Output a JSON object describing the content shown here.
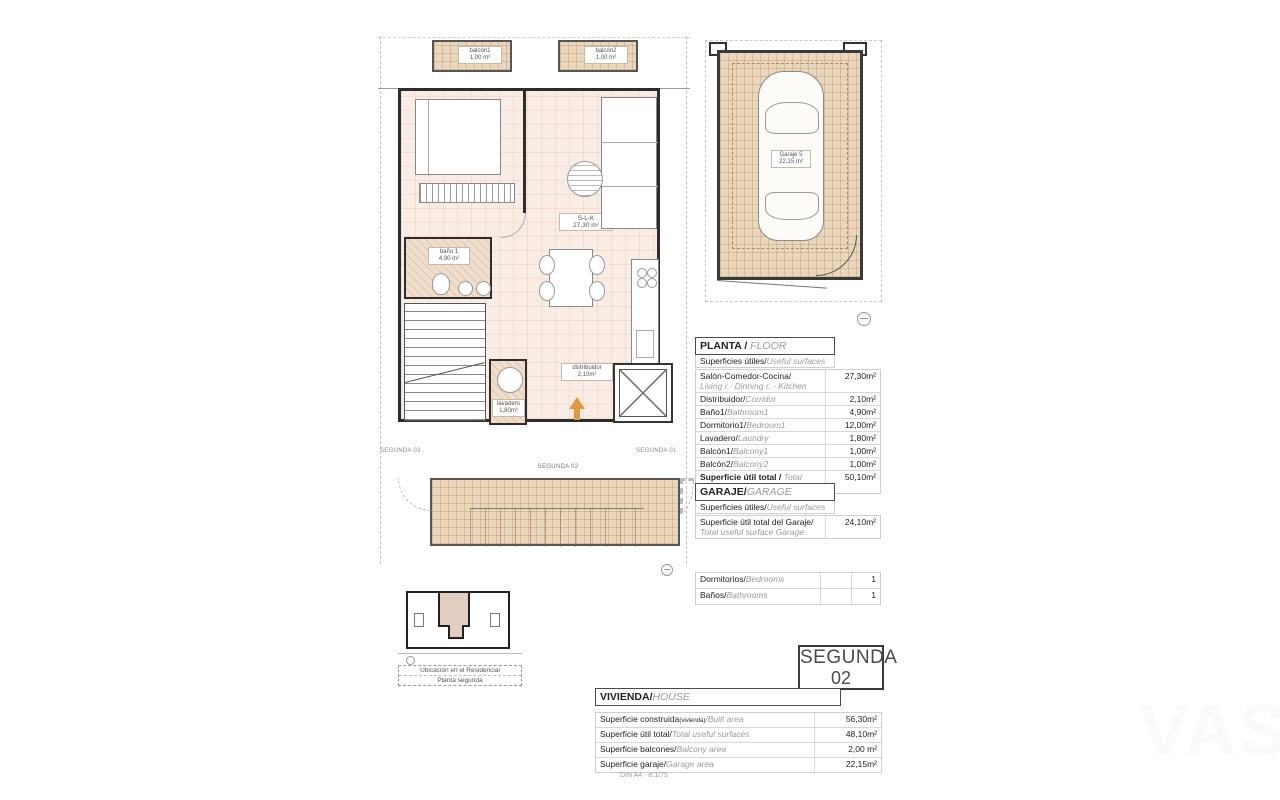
{
  "floor_plan": {
    "balcony1_label": "balcón1",
    "balcony1_area": "1,00 m²",
    "balcony2_label": "balcón2",
    "balcony2_area": "1,00 m²",
    "slk_label": "S-L-K",
    "slk_area": "27,30 m²",
    "bath_label": "baño 1",
    "bath_area": "4,90 m²",
    "laundry_label": "lavadero",
    "laundry_area": "1,80m²",
    "hall_label": "distribuidor",
    "hall_area": "2,10m²",
    "unit_label": "SEGUNDA 02",
    "left_unit_label": "SEGUNDA 03",
    "right_unit_label": "SEGUNDA 01"
  },
  "garage_plan": {
    "label": "Garaje 5",
    "area": "22,15 m²"
  },
  "floor_table": {
    "title_es": "PLANTA / ",
    "title_en": "FLOOR",
    "subtitle_es": "Superficies útiles/",
    "subtitle_en": "Useful surfaces",
    "rows": [
      {
        "es": "Salón-Comedor-Cocina/",
        "en": "Living r.· Dinning r. · Kitchen",
        "value": "27,30m²"
      },
      {
        "es": "Distribuidor/",
        "en": "Corridor",
        "value": "2,10m²"
      },
      {
        "es": "Baño1/",
        "en": "Bathroom1",
        "value": "4,90m²"
      },
      {
        "es": "Dormitorio1/",
        "en": "Bedroom1",
        "value": "12,00m²"
      },
      {
        "es": "Lavadero/",
        "en": "Laundry",
        "value": "1,80m²"
      },
      {
        "es": "Balcón1/",
        "en": "Balcony1",
        "value": "1,00m²"
      },
      {
        "es": "Balcón2/",
        "en": "Balcony2",
        "value": "1,00m²"
      }
    ],
    "total_es": "Superficie útil total / ",
    "total_en": "Total useful surface",
    "total_value": "50,10m²"
  },
  "garage_table": {
    "title_es": "GARAJE/",
    "title_en": "GARAGE",
    "subtitle_es": "Superficies útiles/",
    "subtitle_en": "Useful surfaces",
    "row_es": "Superficie útil total del Garaje/",
    "row_en": "Total useful surface Garage",
    "row_value": "24,10m²"
  },
  "rooms_table": {
    "rows": [
      {
        "es": "Dormitorios/",
        "en": "Bedrooms",
        "value": "1"
      },
      {
        "es": "Baños/",
        "en": "Bathrooms",
        "value": "1"
      }
    ]
  },
  "badge": {
    "line1": "SEGUNDA",
    "line2": "02"
  },
  "house_table": {
    "title_es": "VIVIENDA/",
    "title_en": "HOUSE",
    "rows": [
      {
        "es": "Superficie construida",
        "small": "(vivienda)",
        "en": "/Built area",
        "value": "56,30m²"
      },
      {
        "es": "Superficie útil total/",
        "small": "",
        "en": "Total useful surfaces",
        "value": "48,10m²"
      },
      {
        "es": "Superficie balcones/",
        "small": "",
        "en": "Balcony area",
        "value": "2,00 m²"
      },
      {
        "es": "Superficie garaje/",
        "small": "",
        "en": "Garage area",
        "value": "22,15m²"
      }
    ]
  },
  "location": {
    "line1": "Ubicación en el Residencial",
    "line2": "Planta segunda"
  },
  "footer": {
    "scale": "DIN A4 - e:1/75"
  },
  "watermark": "VAS",
  "colors": {
    "accent_arrow": "#e0993f",
    "tan": "#e9d6bd",
    "pink": "#f9ece5"
  }
}
